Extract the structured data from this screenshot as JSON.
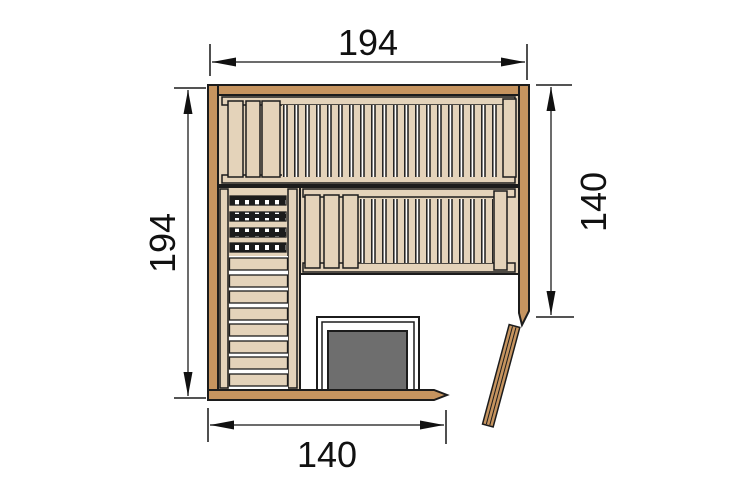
{
  "diagram": {
    "title": "Sauna floor plan (top view, corner entry)",
    "dimensions": {
      "top": "194",
      "left": "194",
      "right": "140",
      "bottom": "140"
    },
    "colors": {
      "wall": "#c6945f",
      "bench": "#e4d3ba",
      "outline": "#1c1c1c",
      "heater": "#6e6e6e",
      "floor": "#ffffff",
      "dimension": "#3c3c3c",
      "text": "#111111"
    }
  }
}
